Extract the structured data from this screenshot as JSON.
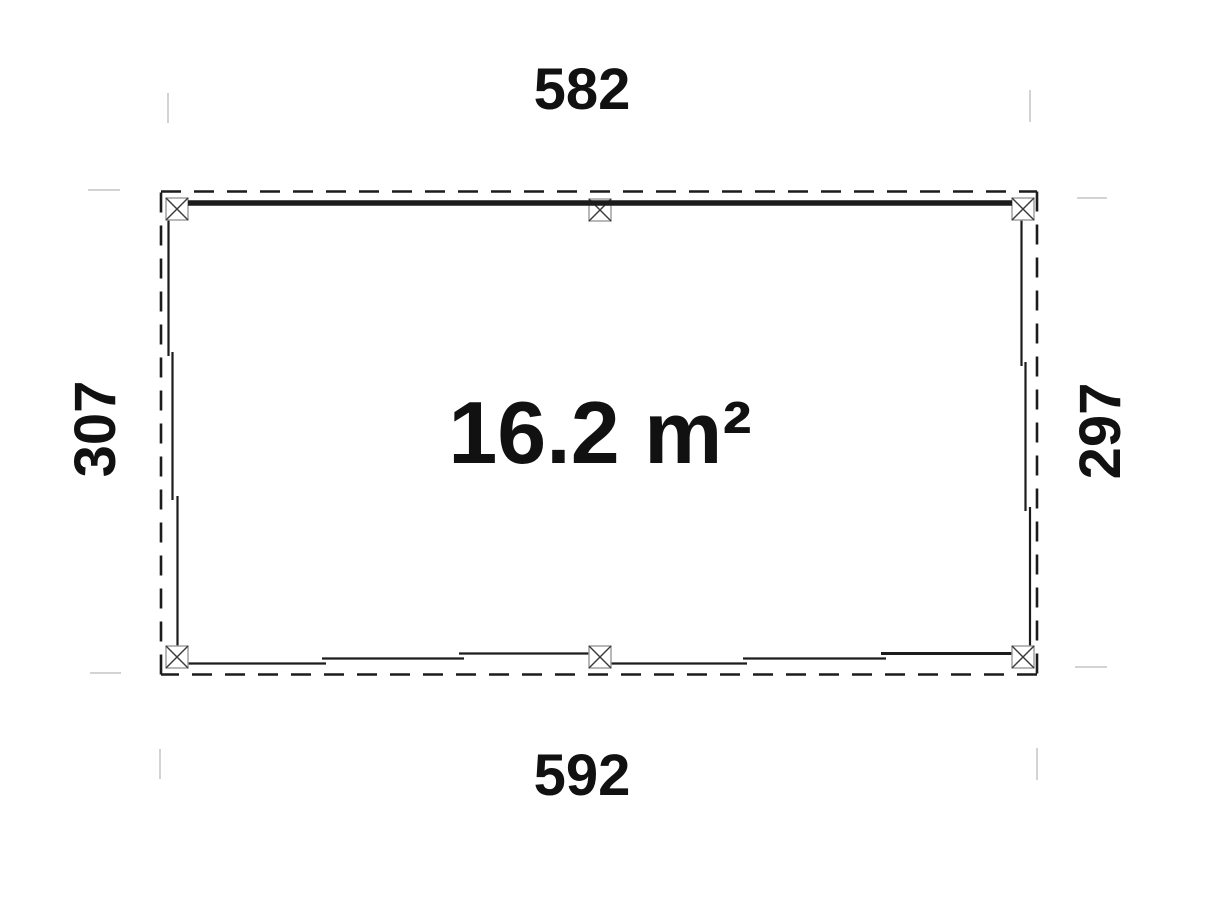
{
  "page": {
    "background": "#ffffff",
    "description_label": "floor plan drawing"
  },
  "plan": {
    "area_label": "16.2 m²",
    "dimensions": {
      "top": "582",
      "bottom": "592",
      "left": "307",
      "right": "297"
    },
    "post_symbol": "square-with-x-cross",
    "post_count": 6
  },
  "colors": {
    "wall_line": "#1c1c1c",
    "roof_dash": "#1c1c1c",
    "post_border": "#9a9a9a",
    "post_fill": "#ffffff",
    "post_cross": "#3a3a3a",
    "extension_tick": "#d3d3d3",
    "text": "#111111"
  }
}
